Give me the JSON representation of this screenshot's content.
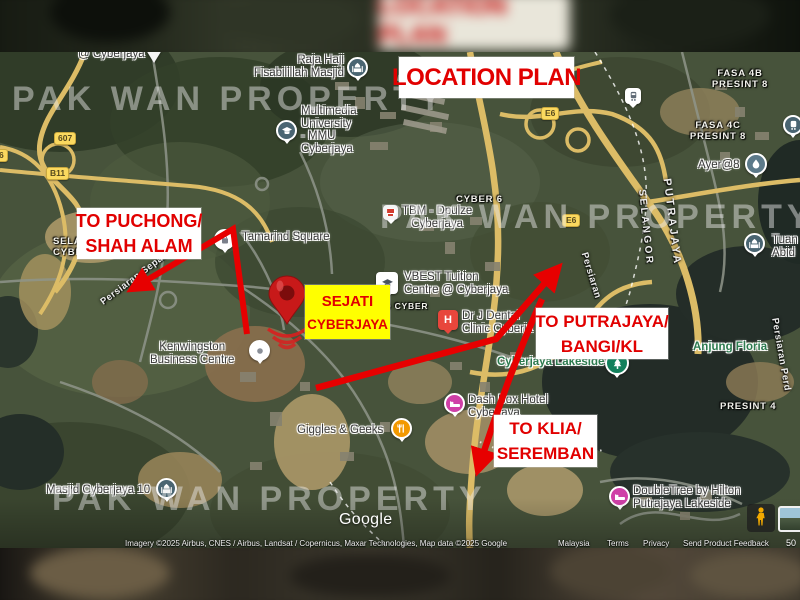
{
  "letterbox": {
    "blurred_title": "LOCATION PLAN"
  },
  "header": {
    "title": "LOCATION PLAN"
  },
  "watermark": {
    "text": "PAK WAN PROPERTY"
  },
  "colors": {
    "annotation_red": "#e10000",
    "highlight_yellow": "#ffff00",
    "callout_bg": "#ffffff"
  },
  "callouts": {
    "puchong": {
      "line1": "TO PUCHONG/",
      "line2": "SHAH ALAM"
    },
    "sejati": {
      "line1": "SEJATI",
      "line2": "CYBERJAYA"
    },
    "putrajaya": {
      "line1": "TO PUTRAJAYA/",
      "line2": "BANGI/KL"
    },
    "klia": {
      "line1": "TO KLIA/",
      "line2": "SEREMBAN"
    }
  },
  "map": {
    "pois": {
      "cyberjaya_at": {
        "label": "@ Cyberjaya"
      },
      "raja_haji": {
        "line1": "Raja Haji",
        "line2": "Fisabilillah Masjid"
      },
      "mmu": {
        "line1": "Multimedia",
        "line2": "University",
        "line3": "- MMU",
        "line4": "Cyberjaya"
      },
      "tamarind": {
        "label": "Tamarind Square"
      },
      "tbm": {
        "line1": "TBM - Dpulze",
        "line2": "Cyberjaya"
      },
      "vbest": {
        "line1": "VBEST Tuition",
        "line2": "Centre @ Cyberjaya"
      },
      "dental": {
        "line1": "Dr J Dental",
        "line2": "Clinic Cyberja"
      },
      "kenwingston": {
        "line1": "Kenwingston",
        "line2": "Business Centre"
      },
      "giggles": {
        "label": "Giggles & Geeks"
      },
      "dashbox": {
        "line1": "Dash Box Hotel",
        "line2": "Cyberjaya"
      },
      "lakeside": {
        "label": "Cyberjaya Lakeside"
      },
      "anjung": {
        "label": "Anjung Floria"
      },
      "doubletree": {
        "line1": "DoubleTree by Hilton",
        "line2": "Putrajaya Lakeside"
      },
      "masjid10": {
        "label": "Masjid Cyberjaya 10"
      },
      "ayer8": {
        "label": "Ayer@8"
      },
      "tuan": {
        "line1": "Tuan",
        "line2": "Abid"
      },
      "hospital_letter": "H"
    },
    "areas": {
      "fasa4b": {
        "line1": "FASA 4B",
        "line2": "PRESINT 8"
      },
      "fasa4c": {
        "line1": "FASA 4C",
        "line2": "PRESINT 8"
      },
      "presint4": {
        "label": "PRESINT 4"
      },
      "sela": {
        "line1": "SELA",
        "line2": "CYBER"
      },
      "cyber6": {
        "label": "CYBER 6"
      },
      "ocyber": {
        "label": "O CYBER"
      }
    },
    "roads": {
      "putrajaya": "PUTRAJAYA",
      "selangor": "SELANGOR",
      "persiaran_sepang": "Persiaran Sepang",
      "persiaran": "Persiaran",
      "persiaran_perdana": "Persiaran Perd"
    },
    "badges": {
      "b607": "607",
      "b11": "B11",
      "e6_top": "E6",
      "e6_mid": "E6",
      "edge": "6"
    }
  },
  "google": {
    "logo": "Google",
    "attribution": "Imagery ©2025 Airbus, CNES / Airbus, Landsat / Copernicus, Maxar Technologies, Map data ©2025 Google",
    "country": "Malaysia",
    "terms": "Terms",
    "privacy": "Privacy",
    "feedback": "Send Product Feedback",
    "scale": "50"
  }
}
